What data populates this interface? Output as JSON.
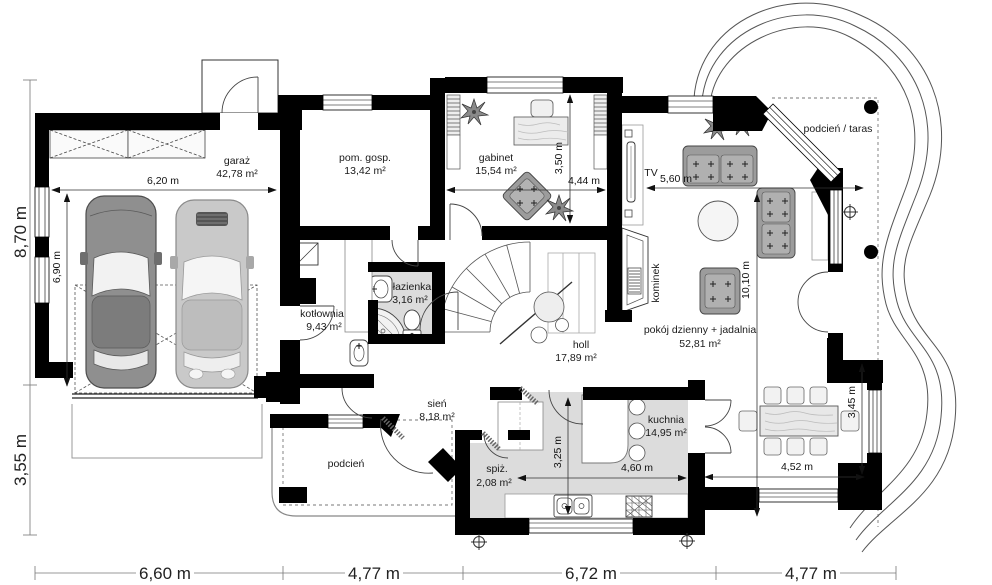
{
  "plan": {
    "rooms": {
      "garaz": {
        "name": "garaż",
        "area": "42,78 m²"
      },
      "pom_gosp": {
        "name": "pom. gosp.",
        "area": "13,42 m²"
      },
      "gabinet": {
        "name": "gabinet",
        "area": "15,54 m²"
      },
      "kotlownia": {
        "name": "kotłownia",
        "area": "9,43 m²"
      },
      "lazienka": {
        "name": "łazienka",
        "area": "3,16 m²"
      },
      "sien": {
        "name": "sień",
        "area": "8,18 m²"
      },
      "holl": {
        "name": "holl",
        "area": "17,89 m²"
      },
      "spiz": {
        "name": "spiż.",
        "area": "2,08 m²"
      },
      "kuchnia": {
        "name": "kuchnia",
        "area": "14,95 m²"
      },
      "pokoj_dzienny": {
        "name": "pokój dzienny + jadalnia",
        "area": "52,81 m²"
      },
      "podcien_taras": {
        "name": "podcień / taras"
      },
      "podcien": {
        "name": "podcień"
      }
    },
    "features": {
      "tv": "TV",
      "kominek": "kominek"
    },
    "dimensions": {
      "left_upper": "8,70 m",
      "left_lower": "3,55 m",
      "bottom": [
        "6,60 m",
        "4,77 m",
        "6,72 m",
        "4,77 m"
      ],
      "garage_width": "6,20 m",
      "garage_depth": "6,90 m",
      "gabinet_width": "4,44 m",
      "gabinet_depth": "3,50 m",
      "living_width": "5,60 m",
      "living_depth": "10,10 m",
      "kitchen_width": "4,60 m",
      "kitchen_depth": "3,25 m",
      "dining_width": "4,52 m",
      "dining_depth": "3,45 m"
    },
    "colors": {
      "wall": "#000000",
      "floor_gray": "#dcdcdc",
      "furniture_gray": "#9c9c9c",
      "car_dark": "#8f8f8f",
      "car_light": "#c8c8c8"
    }
  }
}
